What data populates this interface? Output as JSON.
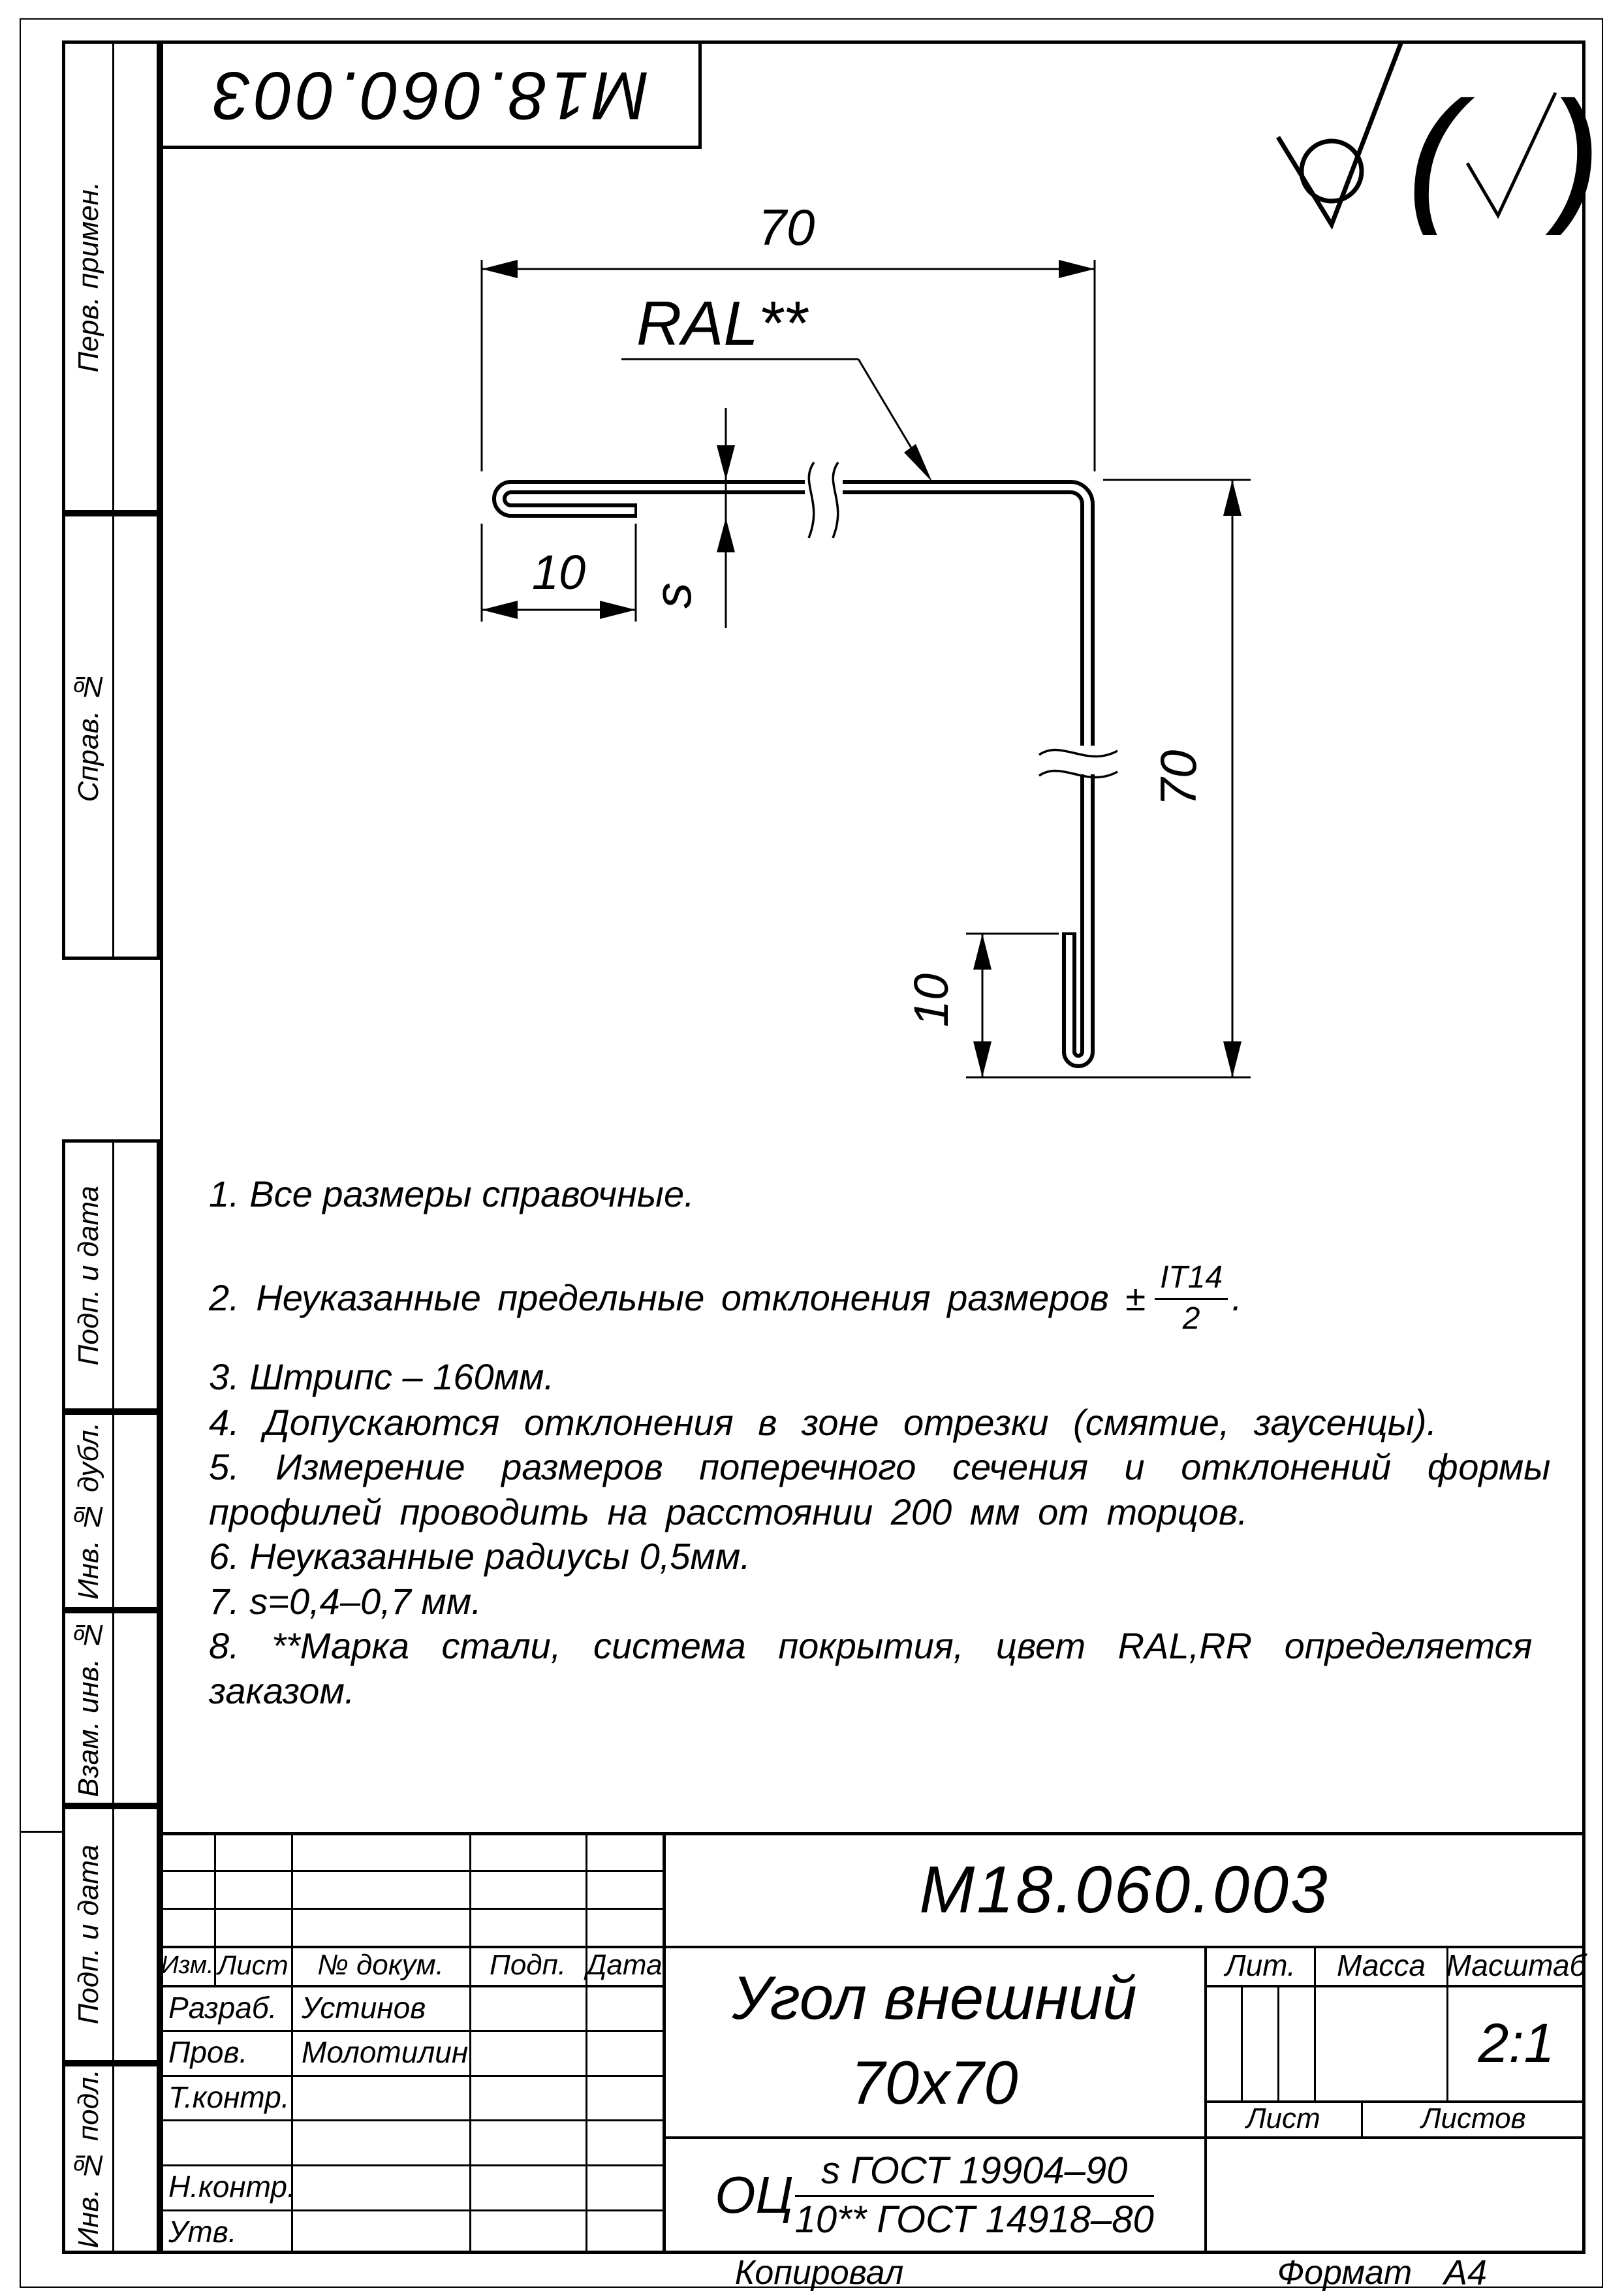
{
  "stamp": {
    "doc_number": "М18.060.003"
  },
  "surface_finish": {
    "open_paren": "(",
    "close_paren": ")"
  },
  "margin_labels": {
    "perv": "Перв. примен.",
    "sprav": "Справ. №",
    "podp1": "Подп. и дата",
    "inv_dubl": "Инв. № дубл.",
    "vzam": "Взам. инв. №",
    "podp2": "Подп. и дата",
    "inv_podl": "Инв. № подл."
  },
  "drawing": {
    "dim_top": "70",
    "dim_right": "70",
    "dim_hem_left": "10",
    "dim_hem_bottom": "10",
    "thickness": "s",
    "coating": "RAL**"
  },
  "notes": {
    "n1": "1.  Все размеры справочные.",
    "n2_prefix": "2.  Неуказанные предельные отклонения размеров ±",
    "n2_num": "IT14",
    "n2_den": "2",
    "n2_suffix": ".",
    "n3": "3.  Штрипс – 160мм.",
    "n4": "4.  Допускаются отклонения в зоне отрезки (смятие, заусенцы).",
    "n5a": "5.  Измерение размеров поперечного сечения и отклонений формы",
    "n5b": "профилей проводить на расстоянии 200 мм от торцов.",
    "n6": "6.  Неуказанные радиусы 0,5мм.",
    "n7": "7.  s=0,4–0,7 мм.",
    "n8a": "8.  **Марка стали, система покрытия, цвет RAL,RR определяется",
    "n8b": "заказом."
  },
  "title_block": {
    "doc_number": "М18.060.003",
    "name_line1": "Угол внешний",
    "name_line2": "70х70",
    "header": {
      "izm": "Изм.",
      "list": "Лист",
      "doc": "№ докум.",
      "podp": "Подп.",
      "data": "Дата"
    },
    "roles": {
      "razrab": "Разраб.",
      "prov": "Пров.",
      "tkontr": "Т.контр.",
      "nkontr": "Н.контр.",
      "utv": "Утв."
    },
    "people": {
      "razrab": "Устинов",
      "prov": "Молотилин"
    },
    "lit_label": "Лит.",
    "mass_label": "Масса",
    "scale_label": "Масштаб",
    "scale_value": "2:1",
    "sheet_label": "Лист",
    "sheets_label": "Листов",
    "material": {
      "prefix": "ОЦ",
      "numerator": "s ГОСТ 19904–90",
      "denominator": "10** ГОСТ 14918–80"
    }
  },
  "footer": {
    "copied_label": "Копировал",
    "format_label": "Формат",
    "format_value": "А4"
  }
}
